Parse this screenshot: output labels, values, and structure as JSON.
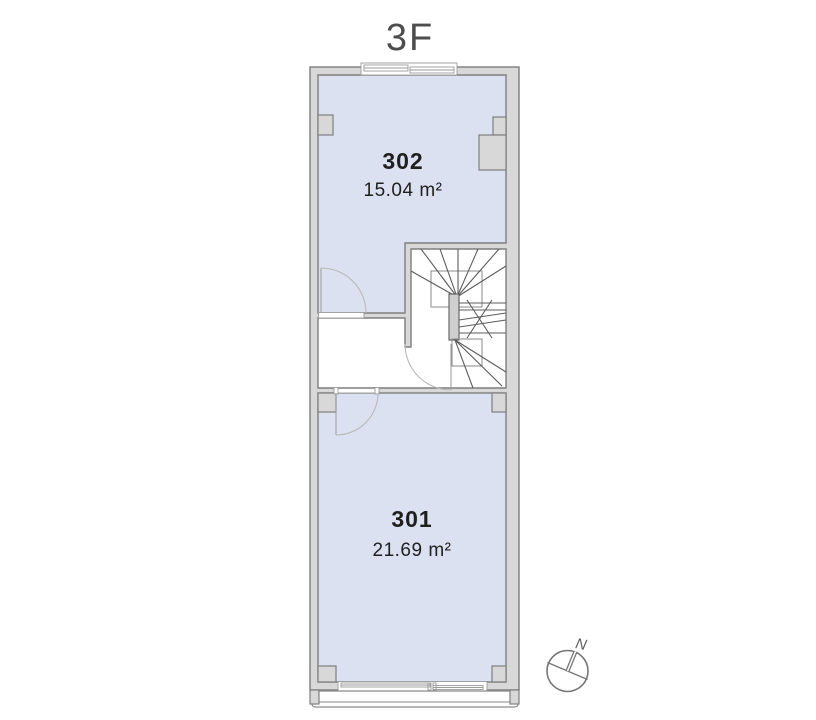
{
  "title": "3F",
  "rooms": [
    {
      "number": "302",
      "area": "15.04 m²"
    },
    {
      "number": "301",
      "area": "21.69 m²"
    }
  ],
  "compass": {
    "label": "N"
  },
  "colors": {
    "room_fill": "#dbe1f0",
    "wall_fill": "#d8d8d8",
    "wall_stroke": "#7e7e7e",
    "stair_line": "#5c5c5c",
    "thin_line": "#9a9a9a",
    "label_text": "#1f1f1f",
    "title_text": "#4d4d4d"
  }
}
